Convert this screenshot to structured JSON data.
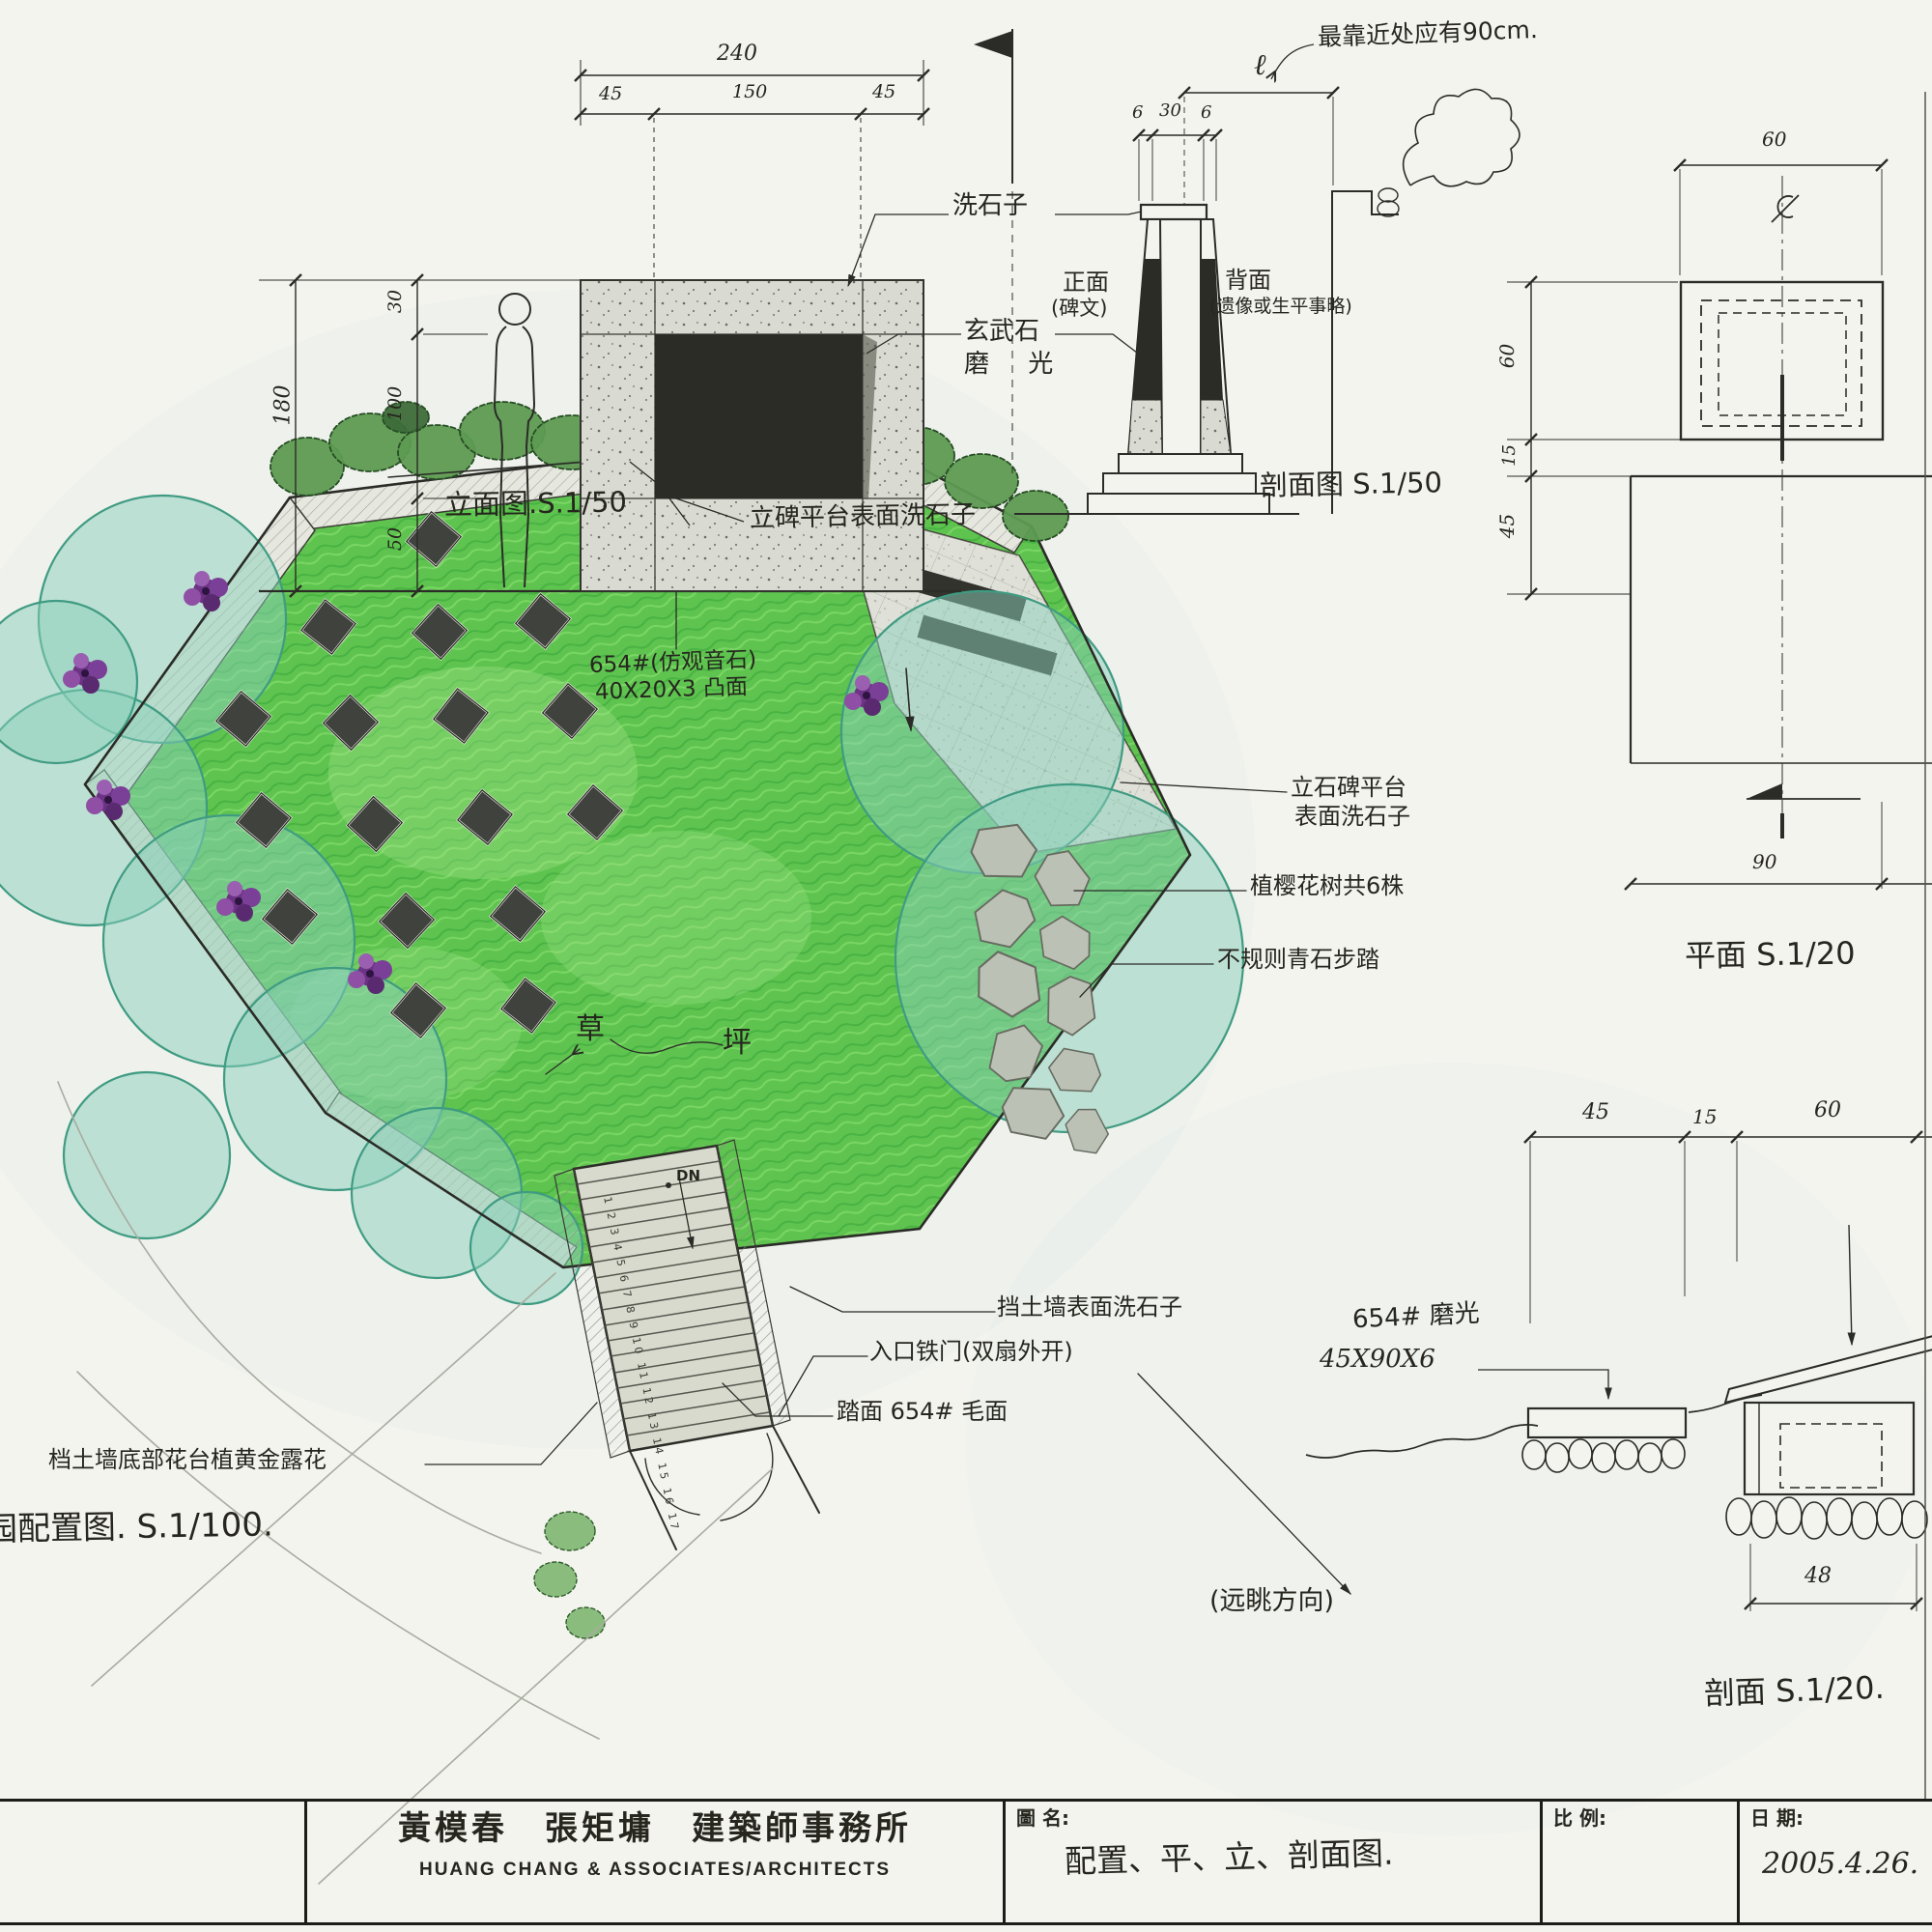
{
  "colors": {
    "paper": "#f3f4ee",
    "ink": "#2b2b27",
    "lawn_green": "#5ec44f",
    "shrub_teal": "#8ad0ba",
    "tree_green": "#5d9a52",
    "flower_purple": "#7c3f94",
    "concrete": "#d9dbd2",
    "basalt": "#2c2c27"
  },
  "elevation": {
    "title": "立面图.S.1/50",
    "note_platform": "立碑平台表面洗石子",
    "note_pebble": "洗石子",
    "note_basalt": "玄武石",
    "note_polished": "磨 光",
    "dim_total_w": "240",
    "dim_w1": "45",
    "dim_w2": "150",
    "dim_w3": "45",
    "dim_total_h": "180",
    "dim_h1": "30",
    "dim_h2": "100",
    "dim_h3": "50"
  },
  "section50": {
    "title": "剖面图 S.1/50",
    "note_nearest": "最靠近处应有90cm.",
    "ell": "ℓ",
    "dim_a": "6",
    "dim_b": "30",
    "dim_c": "6",
    "front_label": "正面",
    "front_sub": "(碑文)",
    "back_label": "背面",
    "back_sub": "(遗像或生平事略)"
  },
  "plan20": {
    "title": "平面 S.1/20",
    "centerline_symbol": "℄",
    "dim_top": "60",
    "dim_left1": "60",
    "dim_left2": "15",
    "dim_left3": "45",
    "dim_bottom": "90"
  },
  "section20": {
    "title": "剖面 S.1/20.",
    "dim_a": "45",
    "dim_b": "15",
    "dim_c": "60",
    "dim_bottom": "48",
    "note_stone": "654# 磨光",
    "note_size": "45X90X6"
  },
  "site": {
    "title": "园配置图. S.1/100.",
    "note_stone1": "654#(仿观音石)",
    "note_stone2": "40X20X3 凸面",
    "grass1": "草",
    "grass2": "坪",
    "note_platform1": "立石碑平台",
    "note_platform2": "表面洗石子",
    "note_cherry": "植樱花树共6株",
    "note_bluestone": "不规则青石步踏",
    "note_wall": "挡土墙表面洗石子",
    "note_gate": "入口铁门(双扇外开)",
    "note_tread": "踏面 654# 毛面",
    "note_view": "(远眺方向)",
    "note_bed": "档土墙底部花台植黄金露花",
    "dn": "DN",
    "step_numbers": "1 2 3 4 5 6 7 8 9 10 11 12 13 14 15 16 17"
  },
  "title_block": {
    "firm_cn": "黃模春　張矩墉　建築師事務所",
    "firm_en": "HUANG CHANG & ASSOCIATES/ARCHITECTS",
    "name_label": "圖 名:",
    "drawing_name": "配置、平、立、剖面图.",
    "scale_label": "比 例:",
    "date_label": "日 期:",
    "date": "2005.4.26."
  }
}
